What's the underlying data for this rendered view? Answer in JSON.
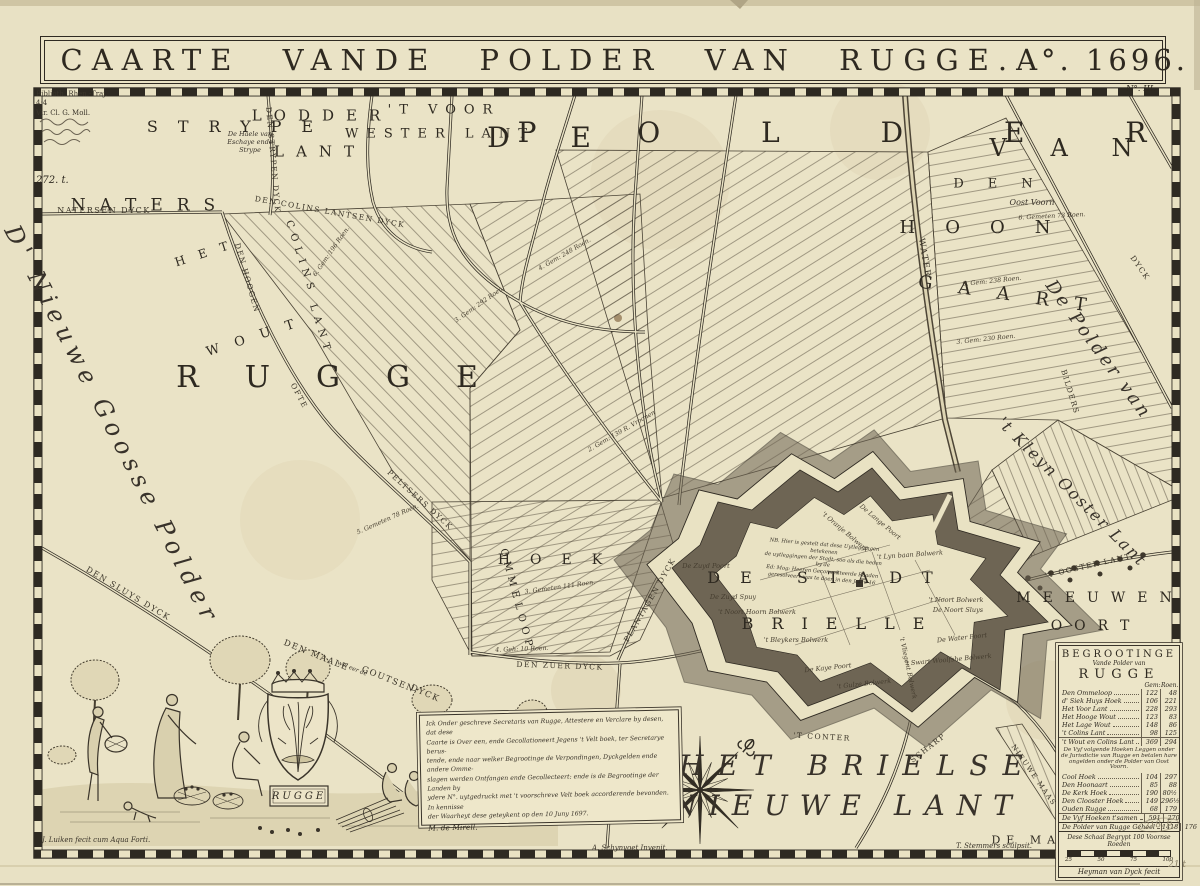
{
  "meta": {
    "sheet_no": "N°. III."
  },
  "title": {
    "main": "CAARTE VANDE POLDER VAN RUGGE.",
    "anno": "A°. 1696."
  },
  "stamp": {
    "lines": [
      "Biblioth. Rhen.-Traj.",
      "4;4",
      "Vir. Cl. G. Moll."
    ],
    "accession": "272. t."
  },
  "pencil": {
    "note1": "218. 6",
    "note2": "21 t"
  },
  "map_labels": [
    {
      "text": "NATERS",
      "x": 150,
      "y": 206,
      "fs": 17,
      "ls": 14,
      "cls": "caps",
      "name": "region-label-naters"
    },
    {
      "text": "STRYPE",
      "x": 240,
      "y": 127,
      "fs": 16,
      "ls": 20,
      "cls": "caps",
      "name": "region-label-strype"
    },
    {
      "text": "LODDER",
      "x": 322,
      "y": 116,
      "fs": 15,
      "ls": 12,
      "cls": "caps",
      "name": "region-label-lodder-lant"
    },
    {
      "text": "LANT",
      "x": 320,
      "y": 152,
      "fs": 15,
      "ls": 12,
      "cls": "caps"
    },
    {
      "text": "'T VOOR",
      "x": 444,
      "y": 110,
      "fs": 13,
      "ls": 8,
      "cls": "caps",
      "name": "region-label-voor-wester-lant"
    },
    {
      "text": "WESTER LANT",
      "x": 440,
      "y": 134,
      "fs": 13,
      "ls": 8,
      "cls": "caps"
    },
    {
      "text": "D E",
      "x": 552,
      "y": 138,
      "fs": 28,
      "ls": 26,
      "cls": "caps",
      "name": "region-label-de-polder"
    },
    {
      "text": "P O L D E R",
      "x": 855,
      "y": 133,
      "fs": 28,
      "ls": 46,
      "cls": "caps"
    },
    {
      "text": "V A N",
      "x": 1070,
      "y": 148,
      "fs": 24,
      "ls": 18,
      "cls": "caps"
    },
    {
      "text": "DEN",
      "x": 1005,
      "y": 184,
      "fs": 13,
      "ls": 24,
      "cls": "caps",
      "name": "region-label-den-hoongaart"
    },
    {
      "text": "HOON",
      "x": 990,
      "y": 228,
      "fs": 18,
      "ls": 30,
      "cls": "caps"
    },
    {
      "text": "GAART",
      "x": 1015,
      "y": 296,
      "fs": 18,
      "ls": 26,
      "rot": 8,
      "cls": "caps"
    },
    {
      "text": "RUGGE",
      "x": 350,
      "y": 378,
      "fs": 30,
      "ls": 46,
      "cls": "caps",
      "name": "region-label-rugge"
    },
    {
      "text": "HET",
      "x": 208,
      "y": 252,
      "fs": 12,
      "ls": 14,
      "rot": -18,
      "cls": "caps",
      "name": "region-label-het-wout"
    },
    {
      "text": "WOUT",
      "x": 258,
      "y": 336,
      "fs": 13,
      "ls": 16,
      "rot": -18,
      "cls": "caps"
    },
    {
      "text": "COLINS",
      "x": 300,
      "y": 258,
      "fs": 10,
      "ls": 6,
      "rot": 72,
      "cls": "caps",
      "name": "region-label-colins-lant"
    },
    {
      "text": "LANT",
      "x": 320,
      "y": 330,
      "fs": 10,
      "ls": 6,
      "rot": 72,
      "cls": "caps"
    },
    {
      "text": "HOEK",
      "x": 560,
      "y": 560,
      "fs": 14,
      "ls": 20,
      "cls": "caps",
      "name": "region-label-hoek"
    },
    {
      "text": "OMMELOOP",
      "x": 516,
      "y": 600,
      "fs": 10,
      "ls": 5,
      "rot": 75,
      "cls": "caps",
      "name": "region-label-ommeloop"
    },
    {
      "text": "DE STADT",
      "x": 830,
      "y": 578,
      "fs": 16,
      "ls": 20,
      "cls": "caps",
      "name": "city-label-de-stadt-brielle"
    },
    {
      "text": "BRIELLE",
      "x": 842,
      "y": 624,
      "fs": 16,
      "ls": 18,
      "cls": "caps"
    },
    {
      "text": "MEEUWEN",
      "x": 1100,
      "y": 598,
      "fs": 14,
      "ls": 12,
      "cls": "caps",
      "name": "region-label-meeuwen-oort"
    },
    {
      "text": "OORT",
      "x": 1096,
      "y": 626,
      "fs": 14,
      "ls": 12,
      "cls": "caps"
    },
    {
      "text": "DE MAAS",
      "x": 1040,
      "y": 840,
      "fs": 11,
      "ls": 6,
      "cls": "caps",
      "name": "region-label-de-maas"
    },
    {
      "text": "NATERSEN DYCK",
      "x": 104,
      "y": 211,
      "fs": 8,
      "cls": "dyk"
    },
    {
      "text": "DEN STRYPEN DYCK",
      "x": 273,
      "y": 160,
      "fs": 7.5,
      "rot": 85,
      "cls": "dyk"
    },
    {
      "text": "DEN COLINS LANTSEN DYCK",
      "x": 330,
      "y": 212,
      "fs": 7.5,
      "rot": 10,
      "cls": "dyk"
    },
    {
      "text": "DEN HOOGEN",
      "x": 247,
      "y": 278,
      "fs": 7.5,
      "rot": 74,
      "cls": "dyk"
    },
    {
      "text": "OFTE",
      "x": 299,
      "y": 396,
      "fs": 7.5,
      "rot": 62,
      "cls": "dyk"
    },
    {
      "text": "PELTSERS DYCK",
      "x": 420,
      "y": 500,
      "fs": 7.5,
      "rot": 42,
      "cls": "dyk"
    },
    {
      "text": "DEN SLUYS DYCK",
      "x": 128,
      "y": 594,
      "fs": 8,
      "rot": 31,
      "cls": "dyk"
    },
    {
      "text": "DEN MAALE",
      "x": 316,
      "y": 656,
      "fs": 8.5,
      "rot": 22,
      "cls": "dyk"
    },
    {
      "text": "wel eer de",
      "x": 352,
      "y": 669,
      "fs": 6,
      "rot": 22,
      "cls": "script"
    },
    {
      "text": "GOUTSEN",
      "x": 388,
      "y": 680,
      "fs": 8.5,
      "rot": 22,
      "cls": "dyk"
    },
    {
      "text": "DYCK",
      "x": 425,
      "y": 694,
      "fs": 8.5,
      "rot": 24,
      "cls": "dyk"
    },
    {
      "text": "DEN ZUER DYCK",
      "x": 560,
      "y": 666,
      "fs": 7.5,
      "rot": 2,
      "cls": "dyk"
    },
    {
      "text": "PLANTAGEN DYCK",
      "x": 650,
      "y": 600,
      "fs": 7.5,
      "rot": -60,
      "cls": "dyk"
    },
    {
      "text": "HELLE DYCK",
      "x": 612,
      "y": 752,
      "fs": 7,
      "rot": 86,
      "cls": "dyk"
    },
    {
      "text": "WATER",
      "x": 924,
      "y": 258,
      "fs": 8.5,
      "rot": 80,
      "cls": "dyk"
    },
    {
      "text": "BILDERS",
      "x": 1070,
      "y": 392,
      "fs": 7.5,
      "rot": 73,
      "cls": "dyk"
    },
    {
      "text": "DYCK",
      "x": 1140,
      "y": 268,
      "fs": 7.5,
      "rot": 55,
      "cls": "dyk"
    },
    {
      "text": "'T OOSTER LANT",
      "x": 1088,
      "y": 566,
      "fs": 7.5,
      "rot": -13,
      "cls": "dyk"
    },
    {
      "text": "NIEUWE MAAS DYCK",
      "x": 1042,
      "y": 788,
      "fs": 7,
      "rot": 55,
      "cls": "dyk"
    },
    {
      "text": "'T CONTER",
      "x": 822,
      "y": 737,
      "fs": 7.5,
      "rot": 3,
      "cls": "dyk"
    },
    {
      "text": "SCHARP",
      "x": 928,
      "y": 748,
      "fs": 7.5,
      "rot": -38,
      "cls": "dyk"
    },
    {
      "text": "D' Nieuwe Goosse Polder",
      "x": 112,
      "y": 425,
      "fs": 24,
      "ls": 6,
      "rot": 63,
      "cls": "script",
      "name": "region-label-nieuwe-goosse-polder"
    },
    {
      "text": "De Polder van",
      "x": 1098,
      "y": 350,
      "fs": 18,
      "ls": 3,
      "rot": 54,
      "cls": "script",
      "name": "region-label-polder-van-kleyn-ooster-lant"
    },
    {
      "text": "'t Kleyn Ooster Lant",
      "x": 1072,
      "y": 492,
      "fs": 16,
      "ls": 2,
      "rot": 45,
      "cls": "script"
    },
    {
      "text": "HET BRIELSE",
      "x": 858,
      "y": 766,
      "fs": 28,
      "ls": 14,
      "cls": "script",
      "name": "region-label-het-brielse-nieuwe-lant"
    },
    {
      "text": "NIEUWE LANT",
      "x": 848,
      "y": 806,
      "fs": 28,
      "ls": 12,
      "cls": "script"
    },
    {
      "text": "Oost Voorn",
      "x": 1032,
      "y": 203,
      "fs": 8,
      "cls": "script"
    },
    {
      "text": "De Haele van",
      "x": 250,
      "y": 134,
      "fs": 6.5,
      "cls": "script"
    },
    {
      "text": "Eschaye ende",
      "x": 250,
      "y": 142,
      "fs": 6.5,
      "cls": "script"
    },
    {
      "text": "Strype",
      "x": 250,
      "y": 150,
      "fs": 6.5,
      "cls": "script"
    },
    {
      "text": "RUGGE",
      "x": 299,
      "y": 797,
      "fs": 10,
      "ls": 3,
      "cls": "plaque-label",
      "name": "crest-plaque-rugge"
    },
    {
      "text": "De Zuyd Poort",
      "x": 706,
      "y": 566,
      "fs": 6.5,
      "cls": "tiny",
      "name": "bastion-label"
    },
    {
      "text": "De Zuyd Spuy",
      "x": 733,
      "y": 597,
      "fs": 6.5,
      "cls": "tiny",
      "name": "bastion-label"
    },
    {
      "text": "'t Noort Hoorn Bolwerk",
      "x": 757,
      "y": 612,
      "fs": 6.5,
      "cls": "tiny",
      "name": "bastion-label"
    },
    {
      "text": "'t Bleykers Bolwerk",
      "x": 796,
      "y": 640,
      "fs": 6.5,
      "cls": "tiny",
      "name": "bastion-label"
    },
    {
      "text": "De Kaye Poort",
      "x": 828,
      "y": 668,
      "fs": 6.5,
      "rot": -6,
      "cls": "tiny",
      "name": "bastion-label"
    },
    {
      "text": "'t Gulze Bolwerk",
      "x": 864,
      "y": 684,
      "fs": 6.5,
      "rot": -6,
      "cls": "tiny",
      "name": "bastion-label"
    },
    {
      "text": "'t Oranje Bolwerk",
      "x": 845,
      "y": 532,
      "fs": 6.5,
      "rot": 40,
      "cls": "tiny",
      "name": "bastion-label"
    },
    {
      "text": "De Lange Poort",
      "x": 880,
      "y": 522,
      "fs": 6.5,
      "rot": 40,
      "cls": "tiny",
      "name": "bastion-label"
    },
    {
      "text": "'t Lyn baan Bolwerk",
      "x": 910,
      "y": 555,
      "fs": 6.5,
      "rot": -4,
      "cls": "tiny",
      "name": "bastion-label"
    },
    {
      "text": "'t Noort Bolwerk",
      "x": 956,
      "y": 600,
      "fs": 6.5,
      "cls": "tiny",
      "name": "bastion-label"
    },
    {
      "text": "De Noort Sluys",
      "x": 958,
      "y": 610,
      "fs": 6.5,
      "cls": "tiny",
      "name": "bastion-label"
    },
    {
      "text": "De Water Poort",
      "x": 962,
      "y": 638,
      "fs": 6.5,
      "rot": -6,
      "cls": "tiny",
      "name": "bastion-label"
    },
    {
      "text": "'t Swart Woolfshe Bolwerk",
      "x": 948,
      "y": 660,
      "fs": 6.5,
      "rot": -5,
      "cls": "tiny",
      "name": "bastion-label"
    },
    {
      "text": "'t Vliegent Bolwerk",
      "x": 908,
      "y": 668,
      "fs": 6.5,
      "rot": 78,
      "cls": "tiny",
      "name": "bastion-label"
    },
    {
      "text": "4. Gem: 248 Roen.",
      "x": 565,
      "y": 255,
      "fs": 6.3,
      "rot": -30,
      "cls": "tiny",
      "name": "parcel-label"
    },
    {
      "text": "3. Gem: 292 Roen.",
      "x": 480,
      "y": 305,
      "fs": 6.3,
      "rot": -35,
      "cls": "tiny",
      "name": "parcel-label"
    },
    {
      "text": "6. Gemeten 73 Roen.",
      "x": 1052,
      "y": 217,
      "fs": 6.3,
      "rot": -3,
      "cls": "tiny",
      "name": "parcel-label"
    },
    {
      "text": "9. Gem: 238 Roen.",
      "x": 992,
      "y": 282,
      "fs": 6.3,
      "rot": -6,
      "cls": "tiny",
      "name": "parcel-label"
    },
    {
      "text": "3. Gem: 230 Roen.",
      "x": 986,
      "y": 340,
      "fs": 6.3,
      "rot": -6,
      "cls": "tiny",
      "name": "parcel-label"
    },
    {
      "text": "2. Gem: 139 R. Vroonen",
      "x": 622,
      "y": 432,
      "fs": 6.3,
      "rot": -30,
      "cls": "tiny",
      "name": "parcel-label"
    },
    {
      "text": "5. Gemeten 78 Roen.",
      "x": 388,
      "y": 520,
      "fs": 6.3,
      "rot": -24,
      "cls": "tiny",
      "name": "parcel-label"
    },
    {
      "text": "4. Geh: 10 Roen.",
      "x": 522,
      "y": 650,
      "fs": 6.3,
      "rot": -2,
      "cls": "tiny",
      "name": "parcel-label"
    },
    {
      "text": "3. Gemeten 111 Roen.",
      "x": 560,
      "y": 588,
      "fs": 6.3,
      "rot": -8,
      "cls": "tiny",
      "name": "parcel-label"
    },
    {
      "text": "6. Gem: 196 Roen.",
      "x": 332,
      "y": 252,
      "fs": 6.3,
      "rot": -55,
      "cls": "tiny",
      "name": "parcel-label"
    }
  ],
  "fort_note": {
    "lines": [
      "NB. Hier is gestelt dat dese Uytleggingen betekenen",
      "de uytleggingen der Stadt, soo als die heden by de",
      "Ed: Mog: Heeren Gecommitteerde Raaden",
      "geresolveert was te doen in den Jaare 16"
    ]
  },
  "cartouche": {
    "lines": [
      "Ick Onder geschreve Secretaris van Rugge, Attestere en Verclare by desen, dat dese",
      "Caarte is Over een, ende Gecollationeert Jegens 't Velt boek, ter Secretarye berus-",
      "tende, ende naar welker Begrootinge de Verpondingen, Dyckgelden ende andere Omme-",
      "slagen werden Ontfangen ende Gecollecteert: ende is de Begrootinge der Landen by",
      "ydere N°. uytgedruckt met 't voorschreve Velt boek accorderende bevonden. In kennisse",
      "der Waarheyt dese geteykent op den 10 Juny 1697."
    ],
    "signature": "M. de Mirell."
  },
  "table": {
    "title": "BEGROOTINGE",
    "subtitle": "Vande Polder van",
    "name": "RUGGE",
    "col_gem": "Gem:",
    "col_roen": "Roen.",
    "rows": [
      {
        "label": "Den Ommeloop",
        "gem": "122",
        "roen": "48"
      },
      {
        "label": "d' Siek Huys Hoek",
        "gem": "106",
        "roen": "221"
      },
      {
        "label": "Het Voor Lant",
        "gem": "228",
        "roen": "293"
      },
      {
        "label": "Het Hooge Wout",
        "gem": "123",
        "roen": "83"
      },
      {
        "label": "Het Lage Wout",
        "gem": "148",
        "roen": "86"
      },
      {
        "label": "'t Colins Lant",
        "gem": "98",
        "roen": "125"
      },
      {
        "label": "'t Wout en Colins Lant",
        "gem": "369",
        "roen": "294",
        "cls": "subtotal"
      },
      {
        "type": "note",
        "lines": [
          "De Vyf volgende Hoeken Leggen onder",
          "de Jurisdictie van Rugge en betalen hare",
          "ongelden onder de Polder van Oost Voorn."
        ]
      },
      {
        "label": "Cool Hoek",
        "gem": "104",
        "roen": "297"
      },
      {
        "label": "Den Hoonaart",
        "gem": "85",
        "roen": "88"
      },
      {
        "label": "De Kerk Hoek",
        "gem": "190",
        "roen": "80½"
      },
      {
        "label": "Den Clooster Hoek",
        "gem": "149",
        "roen": "296½"
      },
      {
        "label": "Ouden Rugge",
        "gem": "68",
        "roen": "179"
      },
      {
        "label": "De Vyf Hoeken t'samen",
        "gem": "591",
        "roen": "270",
        "cls": "subtotal"
      },
      {
        "label": "De Polder van Rugge Geheel",
        "gem": "1418",
        "roen": "176",
        "cls": "total"
      }
    ],
    "scale_label": "Dese Schaal Begrypt 100 Voornse Roeden",
    "scale_ticks": [
      "25",
      "50",
      "75",
      "100"
    ],
    "scale_credit": "Heyman van Dyck fecit"
  },
  "signatures": {
    "etcher": "J. Luiken fecit cum Aqua Forti.",
    "designer": "A. Schynvoet Invenit.",
    "engraver": "T. Stemmers sculpsit."
  }
}
